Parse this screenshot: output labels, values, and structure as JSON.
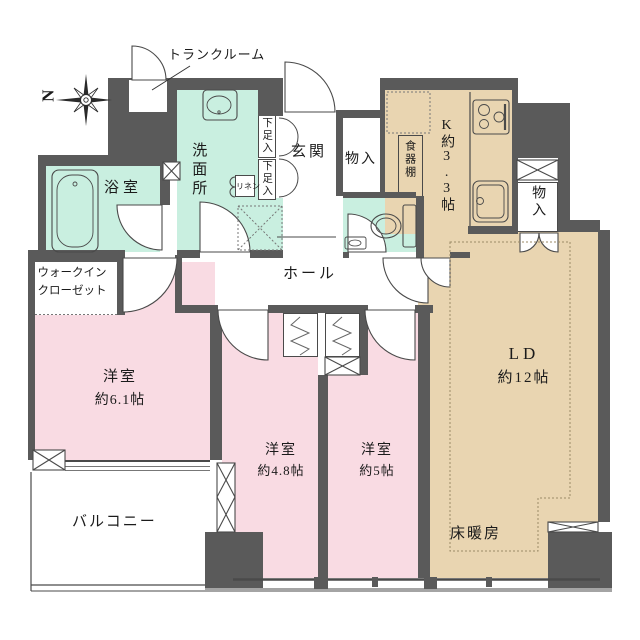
{
  "colors": {
    "wall": "#5a5a5a",
    "wet": "#c9efe0",
    "bedroom": "#f9dbe3",
    "living": "#e9d5b1",
    "line": "#4a4a4a",
    "text": "#1b1b1b"
  },
  "compass": {
    "label": "N"
  },
  "rooms": {
    "trunk_room": {
      "label": "トランクルーム"
    },
    "washroom": {
      "label": "洗面所"
    },
    "bathroom": {
      "label": "浴室"
    },
    "walk_in_closet": {
      "line1": "ウォークイン",
      "line2": "クローゼット"
    },
    "entrance": {
      "label": "玄関"
    },
    "shoe_cabinet_upper": {
      "label": "下足入"
    },
    "shoe_cabinet_lower": {
      "label": "下足入"
    },
    "linen": {
      "label": "リネン"
    },
    "storage_entrance": {
      "label": "物入"
    },
    "storage_kitchen": {
      "label": "物入"
    },
    "kitchen": {
      "label": "K約3.3帖"
    },
    "cupboard": {
      "label": "食器棚"
    },
    "hall": {
      "label": "ホール"
    },
    "living_dining": {
      "line1": "LD",
      "line2": "約12帖"
    },
    "floor_heating": {
      "label": "床暖房"
    },
    "bedroom_61": {
      "line1": "洋室",
      "line2": "約6.1帖"
    },
    "bedroom_48": {
      "line1": "洋室",
      "line2": "約4.8帖"
    },
    "bedroom_5": {
      "line1": "洋室",
      "line2": "約5帖"
    },
    "balcony": {
      "label": "バルコニー"
    }
  }
}
